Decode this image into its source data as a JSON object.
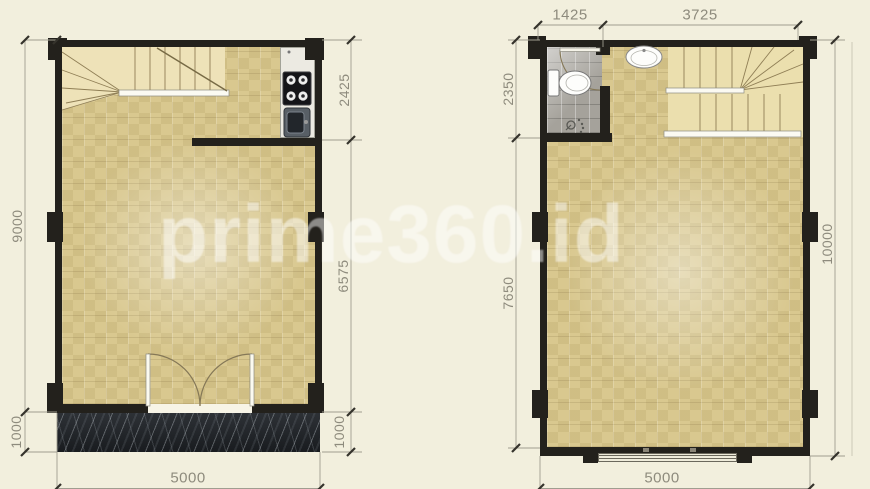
{
  "watermark": {
    "text": "prime360.id"
  },
  "palette": {
    "background": "#f2efdd",
    "wall": "#23211c",
    "floor_tan": "#d9c88f",
    "stair_fill": "#eee2b8",
    "terrace_marble": "#22262b",
    "bathroom_tile": "#a5a29b",
    "dimension_text": "#8e8b7d",
    "watermark_color": "#ffffff"
  },
  "left_plan": {
    "name": "ground-floor-plan",
    "dims": {
      "side_total": "9000",
      "side_porch": "1000",
      "inner_top": "2425",
      "inner_main": "6575",
      "inner_porch": "1000",
      "bottom_width": "5000"
    },
    "fixtures": [
      "staircase",
      "stove",
      "kitchen-sink",
      "double-door",
      "marble-porch"
    ]
  },
  "right_plan": {
    "name": "upper-floor-plan",
    "dims": {
      "top_left": "1425",
      "top_right": "3725",
      "side_top": "2350",
      "side_main": "7650",
      "side_total": "10000",
      "bottom_width": "5000"
    },
    "fixtures": [
      "bathroom",
      "toilet",
      "shower",
      "wash-basin",
      "staircase",
      "window"
    ]
  }
}
